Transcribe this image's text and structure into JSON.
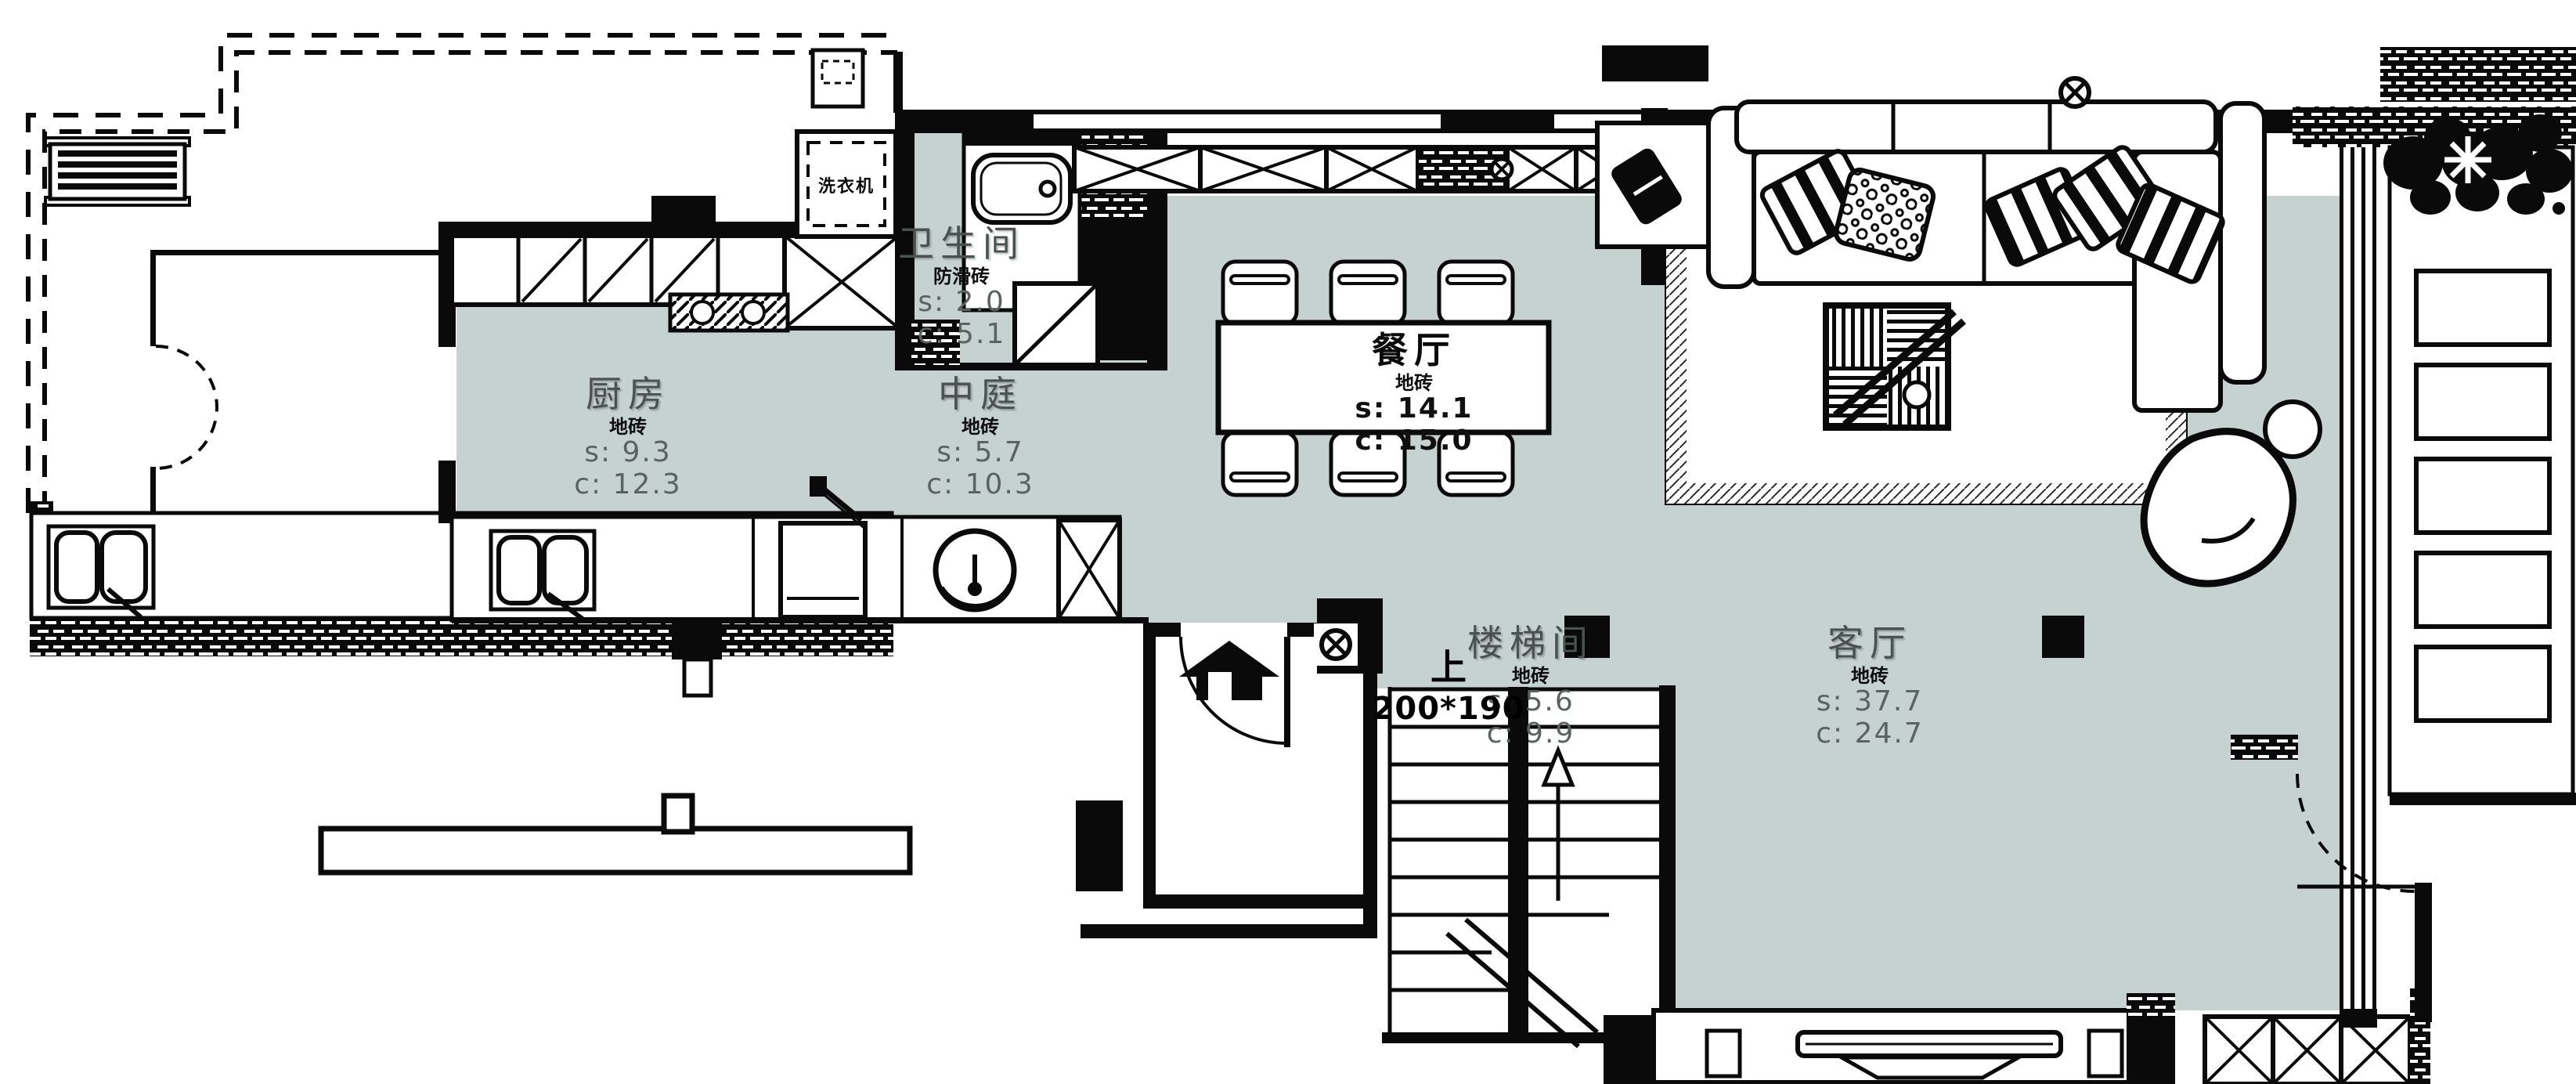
{
  "plan": {
    "colors": {
      "floor": "#c6d2d0",
      "line": "#0a0a0a"
    },
    "rooms": [
      {
        "id": "bathroom",
        "name": "卫生间",
        "material": "防滑砖",
        "s_label": "s: 2.0",
        "c_label": "c: 5.1"
      },
      {
        "id": "kitchen",
        "name": "厨房",
        "material": "地砖",
        "s_label": "s: 9.3",
        "c_label": "c: 12.3"
      },
      {
        "id": "atrium",
        "name": "中庭",
        "material": "地砖",
        "s_label": "s: 5.7",
        "c_label": "c: 10.3"
      },
      {
        "id": "dining",
        "name": "餐厅",
        "material": "地砖",
        "s_label": "s: 14.1",
        "c_label": "c: 15.0"
      },
      {
        "id": "stairwell",
        "name": "楼梯间",
        "material": "地砖",
        "s_label": "s: 5.6",
        "c_label": "c: 9.9"
      },
      {
        "id": "living",
        "name": "客厅",
        "material": "地砖",
        "s_label": "s: 37.7",
        "c_label": "c: 24.7"
      }
    ],
    "stairs": {
      "up_label": "上",
      "tread_size": "200*190"
    },
    "appliances": {
      "washer": "洗衣机"
    }
  }
}
